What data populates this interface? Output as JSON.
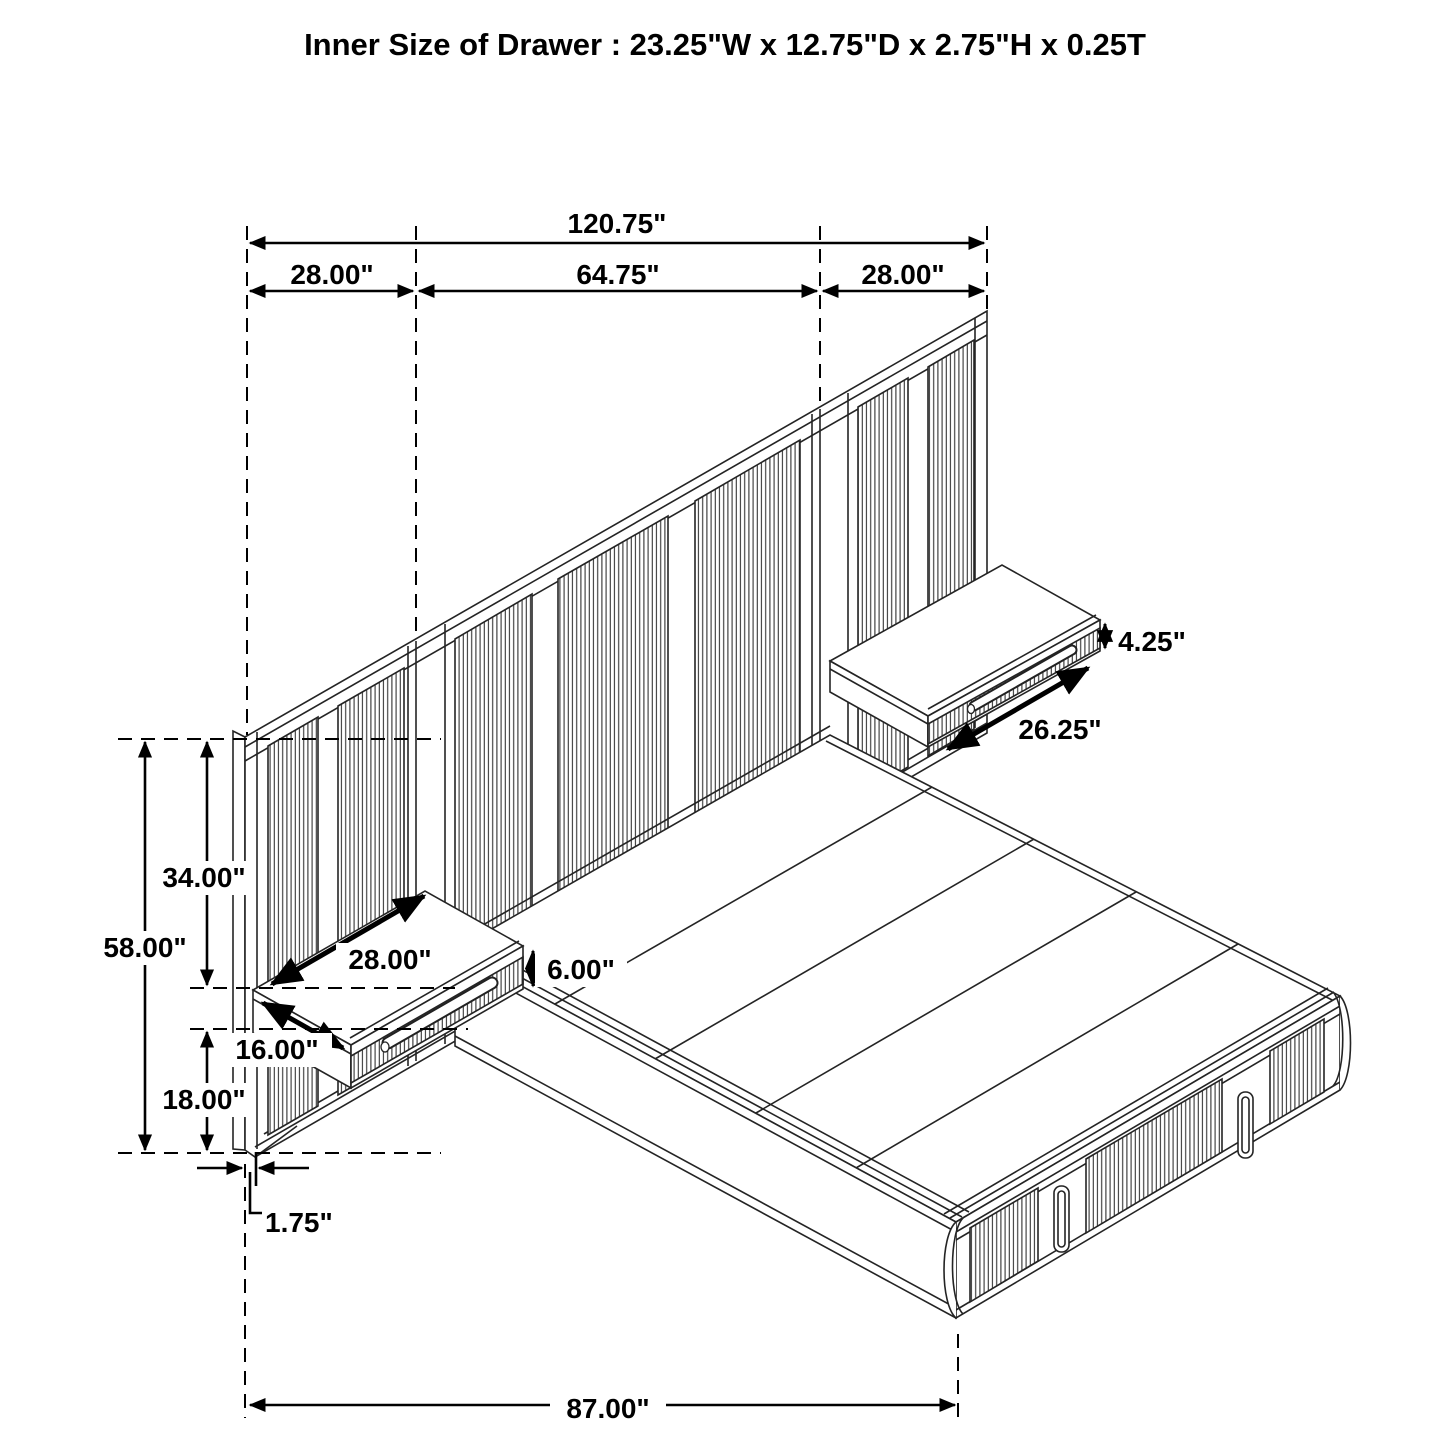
{
  "title": "Inner Size of Drawer : 23.25\"W x 12.75\"D x 2.75\"H x 0.25T",
  "units": "inches",
  "line_color": "#1a1a1a",
  "dimensions": {
    "overall_width": "120.75\"",
    "left_wing_width": "28.00\"",
    "center_width": "64.75\"",
    "right_wing_width": "28.00\"",
    "headboard_height": "58.00\"",
    "upper_section_height": "34.00\"",
    "lower_section_height": "18.00\"",
    "panel_thickness": "1.75\"",
    "left_nightstand_width": "28.00\"",
    "left_nightstand_depth": "16.00\"",
    "left_nightstand_height": "6.00\"",
    "right_nightstand_height": "4.25\"",
    "right_nightstand_width": "26.25\"",
    "bed_base_length": "87.00\""
  }
}
